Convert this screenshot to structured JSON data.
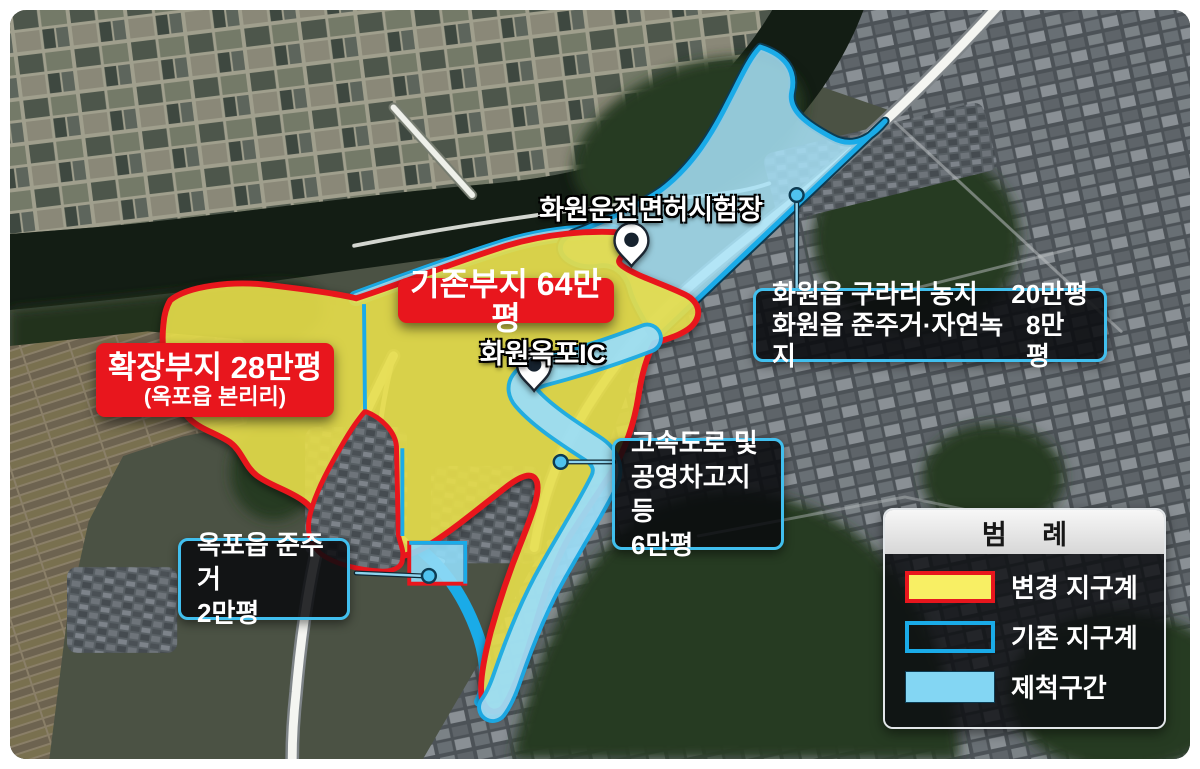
{
  "map_labels": {
    "license_site": "화원운전면허시험장",
    "interchange": "화원옥포IC"
  },
  "area_titles": {
    "existing": "기존부지 64만평",
    "expansion_title": "확장부지 28만평",
    "expansion_subtitle": "(옥포읍 본리리)"
  },
  "callouts": {
    "gurari": {
      "rows": [
        {
          "label": "화원읍 구라리 농지",
          "value": "20만평"
        },
        {
          "label": "화원읍 준주거·자연녹지",
          "value": "8만평"
        }
      ]
    },
    "highway": {
      "lines": [
        "고속도로 및",
        "공영차고지 등",
        "6만평"
      ]
    },
    "okpo": {
      "lines": [
        "옥포읍 준주거",
        "2만평"
      ]
    }
  },
  "legend": {
    "title": "범 례",
    "items": [
      {
        "label": "변경 지구계",
        "swatch": "yellow-fill-red-border"
      },
      {
        "label": "기존 지구계",
        "swatch": "blue-outline"
      },
      {
        "label": "제척구간",
        "swatch": "blue-fill"
      }
    ]
  },
  "colors": {
    "boundary_changed_red": "#e8161d",
    "boundary_existing_blue": "#1aabe8",
    "zone_changed_yellow": "#ede44e",
    "zone_excluded_blue": "#9cddf6",
    "callout_border": "#41bfee"
  }
}
